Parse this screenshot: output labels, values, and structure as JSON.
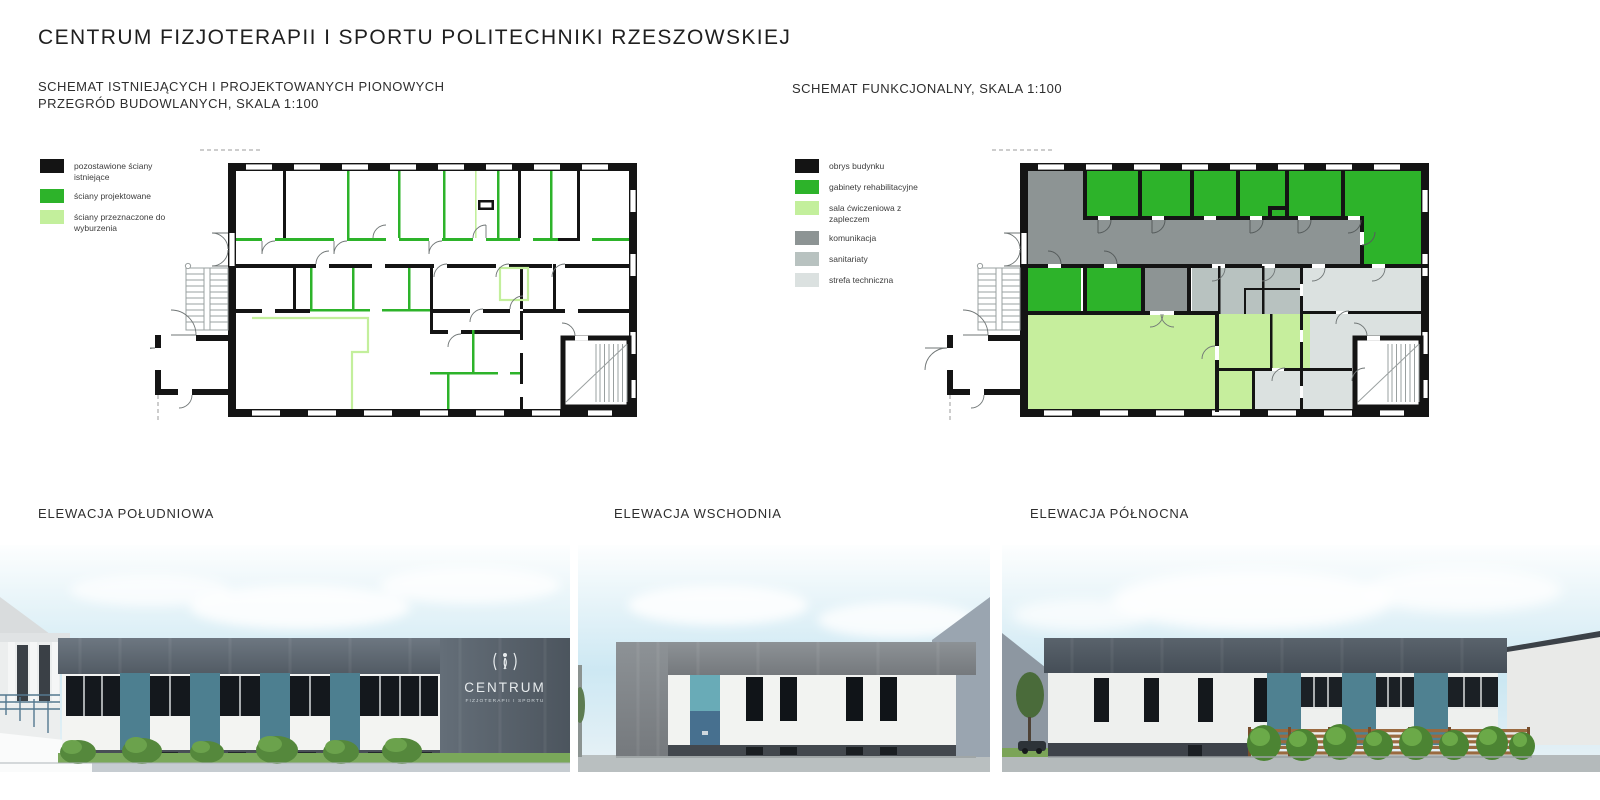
{
  "header": {
    "title": "CENTRUM FIZJOTERAPII I SPORTU POLITECHNIKI RZESZOWSKIEJ"
  },
  "walls_schematic": {
    "title_line1": "SCHEMAT ISTNIEJĄCYCH I PROJEKTOWANYCH PIONOWYCH",
    "title_line2": "PRZEGRÓD BUDOWLANYCH, SKALA 1:100",
    "legend": [
      {
        "label": "pozostawione ściany istniejące",
        "color": "#141414"
      },
      {
        "label": "ściany projektowane",
        "color": "#2db32a"
      },
      {
        "label": "ściany przeznaczone do wyburzenia",
        "color": "#c3ef9c"
      }
    ]
  },
  "functional_schematic": {
    "title": "SCHEMAT FUNKCJONALNY, SKALA 1:100",
    "legend": [
      {
        "label": "obrys budynku",
        "color": "#141414"
      },
      {
        "label": "gabinety rehabilitacyjne",
        "color": "#2db32a"
      },
      {
        "label": "sala ćwiczeniowa z zapleczem",
        "color": "#c3ef9c"
      },
      {
        "label": "komunikacja",
        "color": "#8d9494"
      },
      {
        "label": "sanitariaty",
        "color": "#b8c2c0"
      },
      {
        "label": "strefa techniczna",
        "color": "#dbe1e0"
      }
    ]
  },
  "elevations": {
    "south": {
      "label": "ELEWACJA POŁUDNIOWA"
    },
    "east": {
      "label": "ELEWACJA WSCHODNIA"
    },
    "north": {
      "label": "ELEWACJA PÓŁNOCNA"
    }
  },
  "building_sign": {
    "name": "CENTRUM",
    "subtitle": "FIZJOTERAPII I SPORTU"
  },
  "colors": {
    "wall_existing": "#141414",
    "wall_projected": "#2db32a",
    "wall_demolition": "#c3ef9c",
    "corridor": "#8d9494",
    "sanitary": "#b8c2c0",
    "technical": "#dbe1e0",
    "roof_graphite": "#545d66",
    "facade_white": "#f3f4f2",
    "accent_teal": "#4d7f90",
    "door_blue": "#47708f",
    "grass": "#7aa85a",
    "sky": "#cfe9f3"
  }
}
